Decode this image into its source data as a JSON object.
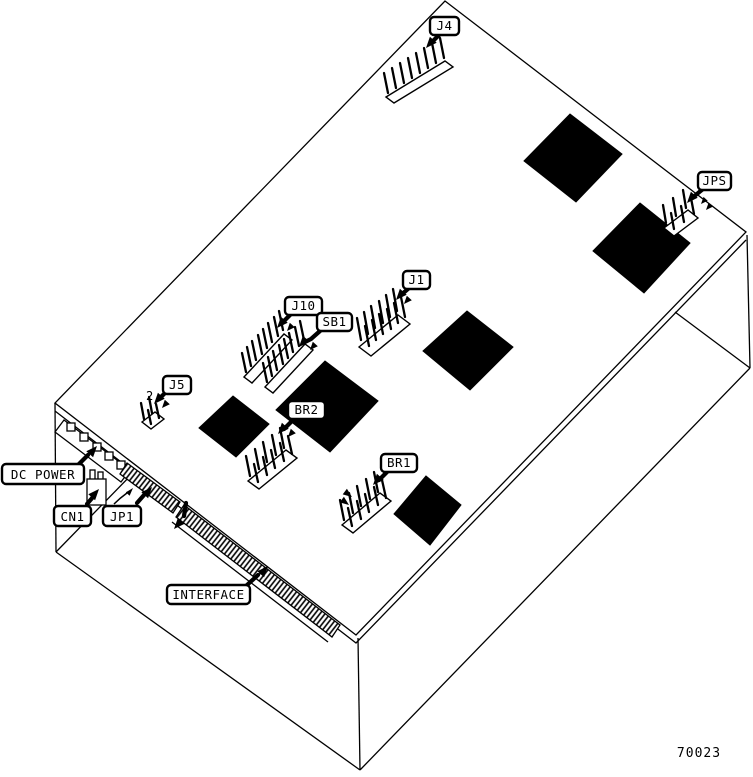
{
  "figure": {
    "part_number": "70023"
  },
  "callouts": {
    "j4": {
      "label": "J4"
    },
    "jps": {
      "label": "JPS"
    },
    "j1": {
      "label": "J1"
    },
    "j10": {
      "label": "J10"
    },
    "sb1": {
      "label": "SB1"
    },
    "j5": {
      "label": "J5"
    },
    "br2": {
      "label": "BR2"
    },
    "br1": {
      "label": "BR1"
    },
    "dc_power": {
      "label": "DC POWER"
    },
    "cn1": {
      "label": "CN1"
    },
    "jp1": {
      "label": "JP1"
    },
    "interface": {
      "label": "INTERFACE"
    }
  },
  "annotations": {
    "j5_pin_number": "2"
  },
  "colors": {
    "line": "#000000",
    "background": "#ffffff",
    "chip_fill": "#000000"
  }
}
